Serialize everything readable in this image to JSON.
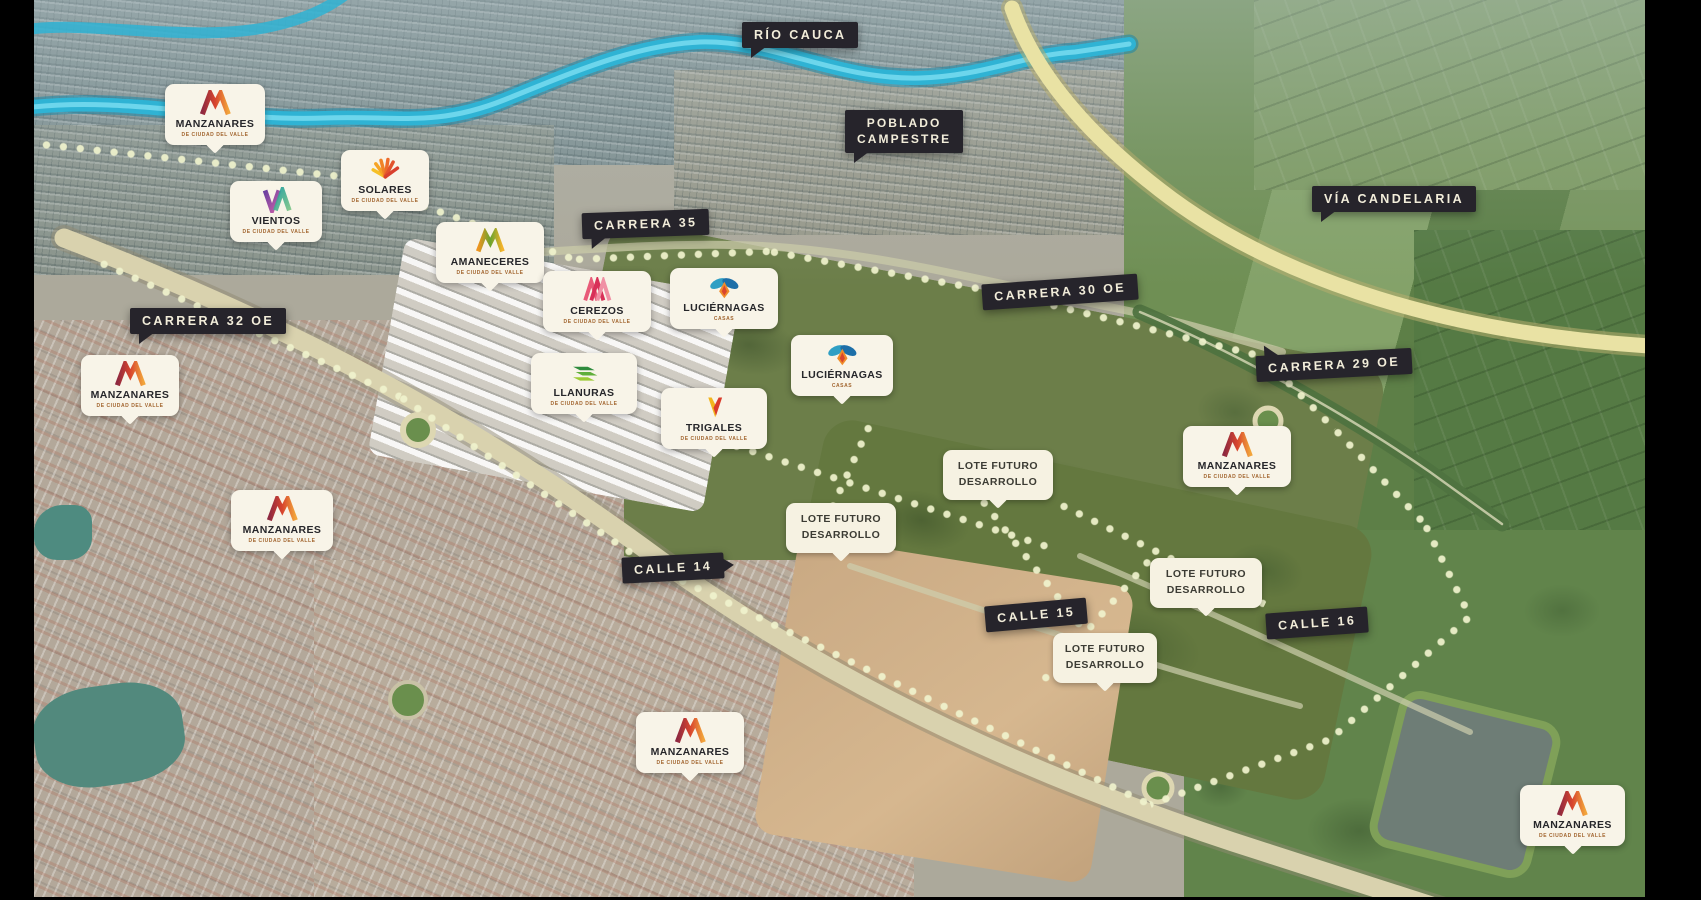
{
  "page": {
    "type": "aerial-masterplan-map"
  },
  "colors": {
    "river": "#2fb3d4",
    "road_banner_bg": "#26242b",
    "road_banner_text": "#f2edda",
    "badge_bg": "#f8f4e8",
    "boundary_dots": "#eef1cd"
  },
  "road_labels": {
    "rio_cauca": "RÍO CAUCA",
    "poblado_campestre_line1": "POBLADO",
    "poblado_campestre_line2": "CAMPESTRE",
    "via_candelaria": "VÍA CANDELARIA",
    "carrera_35": "CARRERA 35",
    "carrera_30_oe": "CARRERA 30 OE",
    "carrera_32_oe": "CARRERA 32 OE",
    "carrera_29_oe": "CARRERA 29 OE",
    "calle_14": "CALLE 14",
    "calle_15": "CALLE 15",
    "calle_16": "CALLE 16"
  },
  "projects": {
    "manzanares": {
      "title": "MANZANARES",
      "subtitle": "DE CIUDAD DEL VALLE",
      "logo": "manzanares-m-icon"
    },
    "solares": {
      "title": "SOLARES",
      "subtitle": "DE CIUDAD DEL VALLE",
      "logo": "solares-sun-icon"
    },
    "vientos": {
      "title": "VIENTOS",
      "subtitle": "DE CIUDAD DEL VALLE",
      "logo": "vientos-va-icon"
    },
    "amaneceres": {
      "title": "AMANECERES",
      "subtitle": "DE CIUDAD DEL VALLE",
      "logo": "amaneceres-mountain-icon"
    },
    "cerezos": {
      "title": "CEREZOS",
      "subtitle": "DE CIUDAD DEL VALLE",
      "logo": "cerezos-stripes-icon"
    },
    "luciernagas": {
      "title": "LUCIÉRNAGAS",
      "subtitle": "CASAS",
      "logo": "luciernagas-firefly-icon"
    },
    "llanuras": {
      "title": "LLANURAS",
      "subtitle": "DE CIUDAD DEL VALLE",
      "logo": "llanuras-chevrons-icon"
    },
    "trigales": {
      "title": "TRIGALES",
      "subtitle": "DE CIUDAD DEL VALLE",
      "logo": "trigales-wheat-icon"
    }
  },
  "lot_label": {
    "line1": "LOTE FUTURO",
    "line2": "DESARROLLO"
  }
}
